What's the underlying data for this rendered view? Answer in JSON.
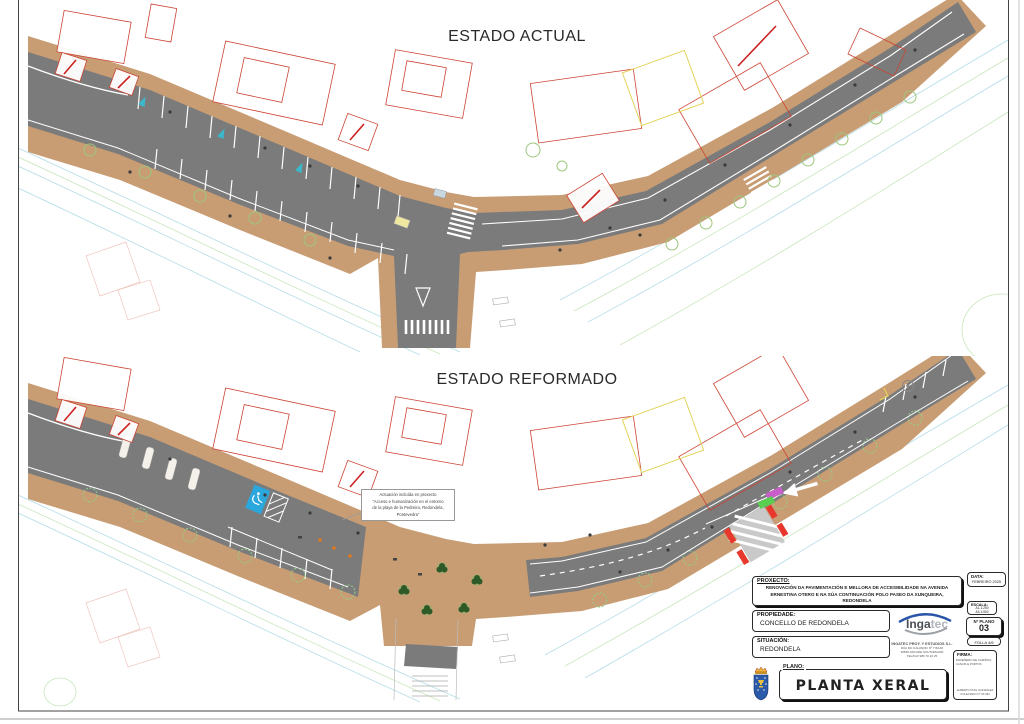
{
  "plans": {
    "actual": {
      "title": "ESTADO ACTUAL"
    },
    "reformado": {
      "title": "ESTADO REFORMADO",
      "annotation": {
        "line1": "Actuación incluída en proxecto",
        "line2": "“Acceso e humanización en el entorno",
        "line3": "de la playa de la Pedreira, Redondela, Pontevedra”"
      }
    }
  },
  "title_block": {
    "proxecto": {
      "label": "PROXECTO:",
      "text": "RENOVACIÓN DA PAVIMENTACIÓN E MELLORA DE ACCESIBILIDADE NA AVENIDA ERNESTINA OTERO E NA SÚA CONTINUACIÓN POLO PASEO DA XUNQUEIRA, REDONDELA"
    },
    "data": {
      "label": "DATA:",
      "value": "FEBREIRO 2025"
    },
    "escala": {
      "label": "ESCALA:",
      "a1": "A1-1:250",
      "a3": "A3-1:500"
    },
    "propiedade": {
      "label": "PROPIEDADE:",
      "value": "CONCELLO DE REDONDELA"
    },
    "n_plano": {
      "label": "Nº PLANO",
      "value": "03"
    },
    "folla": "FOLLA 4/6",
    "situacion": {
      "label": "SITUACIÓN:",
      "value": "REDONDELA"
    },
    "company": {
      "name": "INGATEC PROY. Y ESTUDIOS S.L.",
      "addr1": "RÚA DO CALVARIO Nº 7 BAJO",
      "addr2": "36690 ARCADE SOUTOMAIOR",
      "addr3": "TEL/FAX 986 70 10 25"
    },
    "firma": {
      "label": "FIRMA:",
      "role1": "ENXEÑEIRO DE CAMIÑOS,",
      "role2": "CANAIS E PORTOS",
      "name": "ALBERTO PUIG GONZÁLEZ",
      "colexiado": "COLEXIADO Nº 20.494"
    },
    "plano": {
      "label": "PLANO:",
      "value": "PLANTA XERAL"
    },
    "logo": {
      "part1": "Inga",
      "part2": "tec"
    }
  },
  "colors": {
    "road_gray": "#7b7b7b",
    "sidewalk_tan": "#c89d74",
    "building_outline_red": "#cc4433",
    "contour_cyan": "#b5dde8",
    "contour_green": "#c9e6bd",
    "tree_green": "#9dc77e",
    "tree_dark": "#2d5a27",
    "handicap_blue": "#2aa7dd",
    "mark_red": "#e8382d",
    "mark_magenta": "#c85fc8",
    "mark_green": "#58cf50",
    "arrow_cyan": "#3bb8cc",
    "logo_blue": "#2a55a8"
  }
}
